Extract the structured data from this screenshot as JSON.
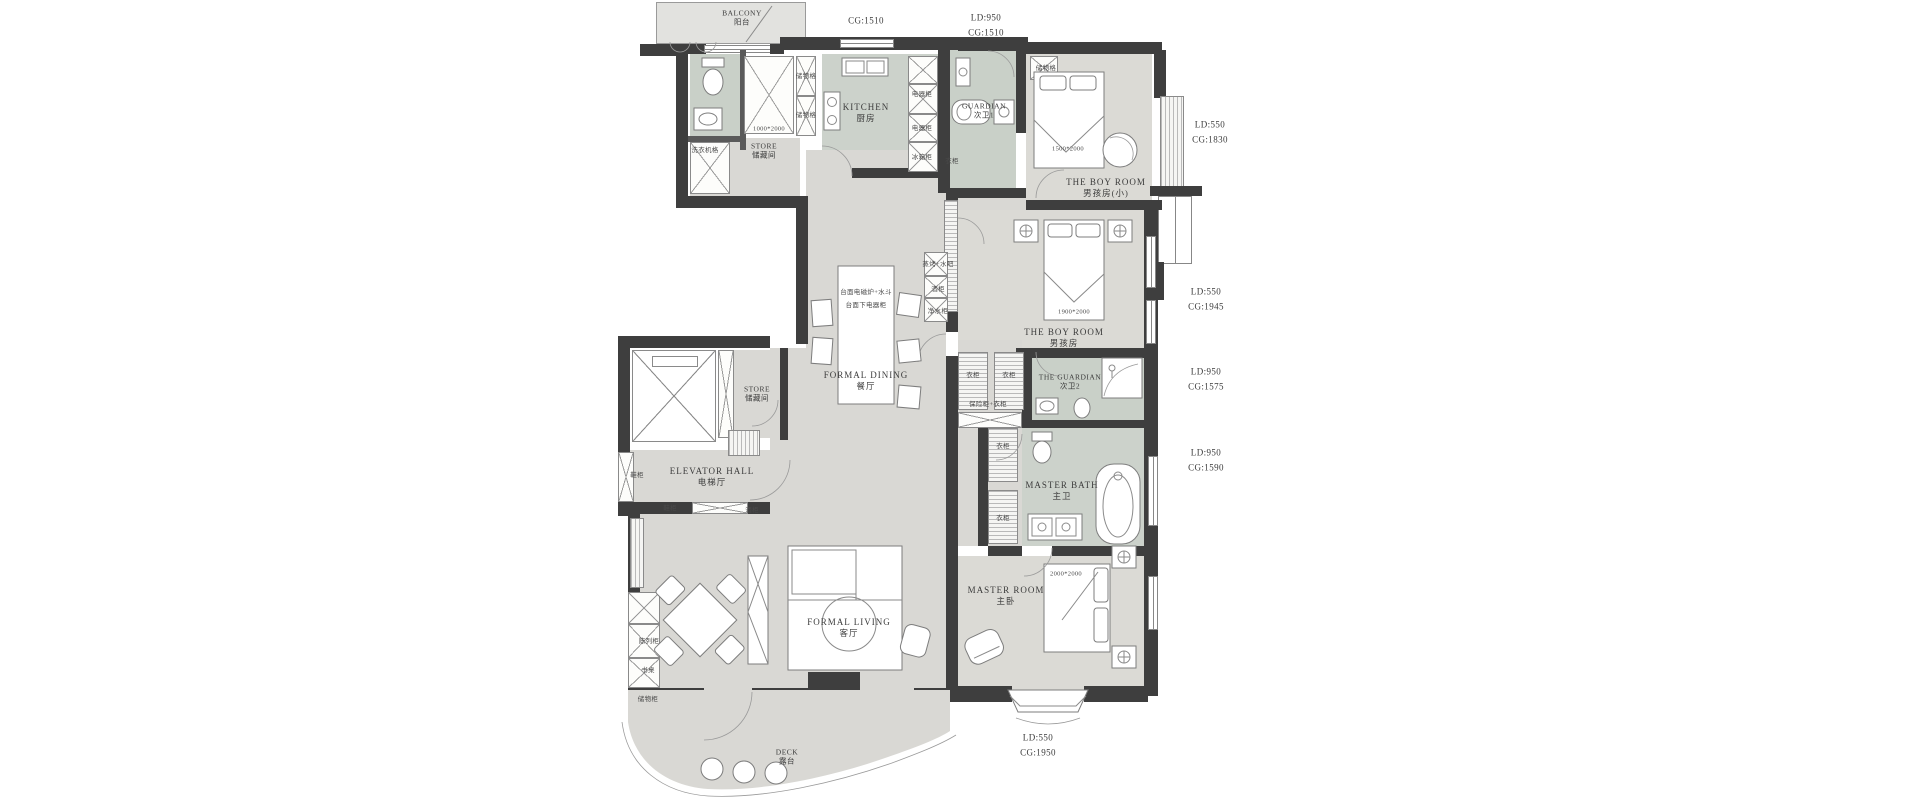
{
  "colors": {
    "wall": "#3e3e3e",
    "floor": "#d9d8d4",
    "wet_floor": "#c9d0c8",
    "outline": "#8a8a8a"
  },
  "rooms": {
    "balcony": {
      "en": "BALCONY",
      "cn": "阳台"
    },
    "kitchen": {
      "en": "KITCHEN",
      "cn": "厨房"
    },
    "store_top": {
      "en": "STORE",
      "cn": "储藏间"
    },
    "guardian1": {
      "en": "GUARDIAN",
      "cn": "次卫1"
    },
    "boy_small": {
      "en": "THE BOY ROOM",
      "cn": "男孩房(小)"
    },
    "dining": {
      "en": "FORMAL DINING",
      "cn": "餐厅"
    },
    "boy": {
      "en": "THE BOY ROOM",
      "cn": "男孩房"
    },
    "guardian2": {
      "en": "THE GUARDIAN",
      "cn": "次卫2"
    },
    "store_mid": {
      "en": "STORE",
      "cn": "储藏间"
    },
    "elevator": {
      "en": "ELEVATOR HALL",
      "cn": "电梯厅"
    },
    "master_bath": {
      "en": "MASTER BATH",
      "cn": "主卫"
    },
    "master": {
      "en": "MASTER ROOM",
      "cn": "主卧"
    },
    "living": {
      "en": "FORMAL LIVING",
      "cn": "客厅"
    },
    "deck": {
      "en": "DECK",
      "cn": "露台"
    }
  },
  "dims": {
    "top_left": "CG:1510",
    "top_right": {
      "l1": "LD:950",
      "l2": "CG:1510"
    },
    "r1": {
      "l1": "LD:550",
      "l2": "CG:1830"
    },
    "r2": {
      "l1": "LD:550",
      "l2": "CG:1945"
    },
    "r3": {
      "l1": "LD:950",
      "l2": "CG:1575"
    },
    "r4": {
      "l1": "LD:950",
      "l2": "CG:1590"
    },
    "bottom": {
      "l1": "LD:550",
      "l2": "CG:1950"
    }
  },
  "sizes": {
    "closet": "1000*2000",
    "bed_small": "1500*2000",
    "bed_boy": "1900*2000",
    "bed_master": "2000*2000"
  },
  "notes": {
    "island1": "台面电磁炉+水斗",
    "island2": "台面下电器柜"
  },
  "cabs": {
    "chuwuge": "储物格",
    "dianqigui": "电器柜",
    "bingxianggui": "冰箱柜",
    "xiyijige": "洗衣机格",
    "yigui": "衣柜",
    "baoxiangui": "保险柜+衣柜",
    "zhengkao": "蒸烤+水吧",
    "jiugui": "酒柜",
    "jingshuigui": "净水柜",
    "xiegui": "鞋柜",
    "chenliegui": "陈列柜",
    "shuzhuo": "书桌",
    "chuwugui": "储物柜"
  }
}
